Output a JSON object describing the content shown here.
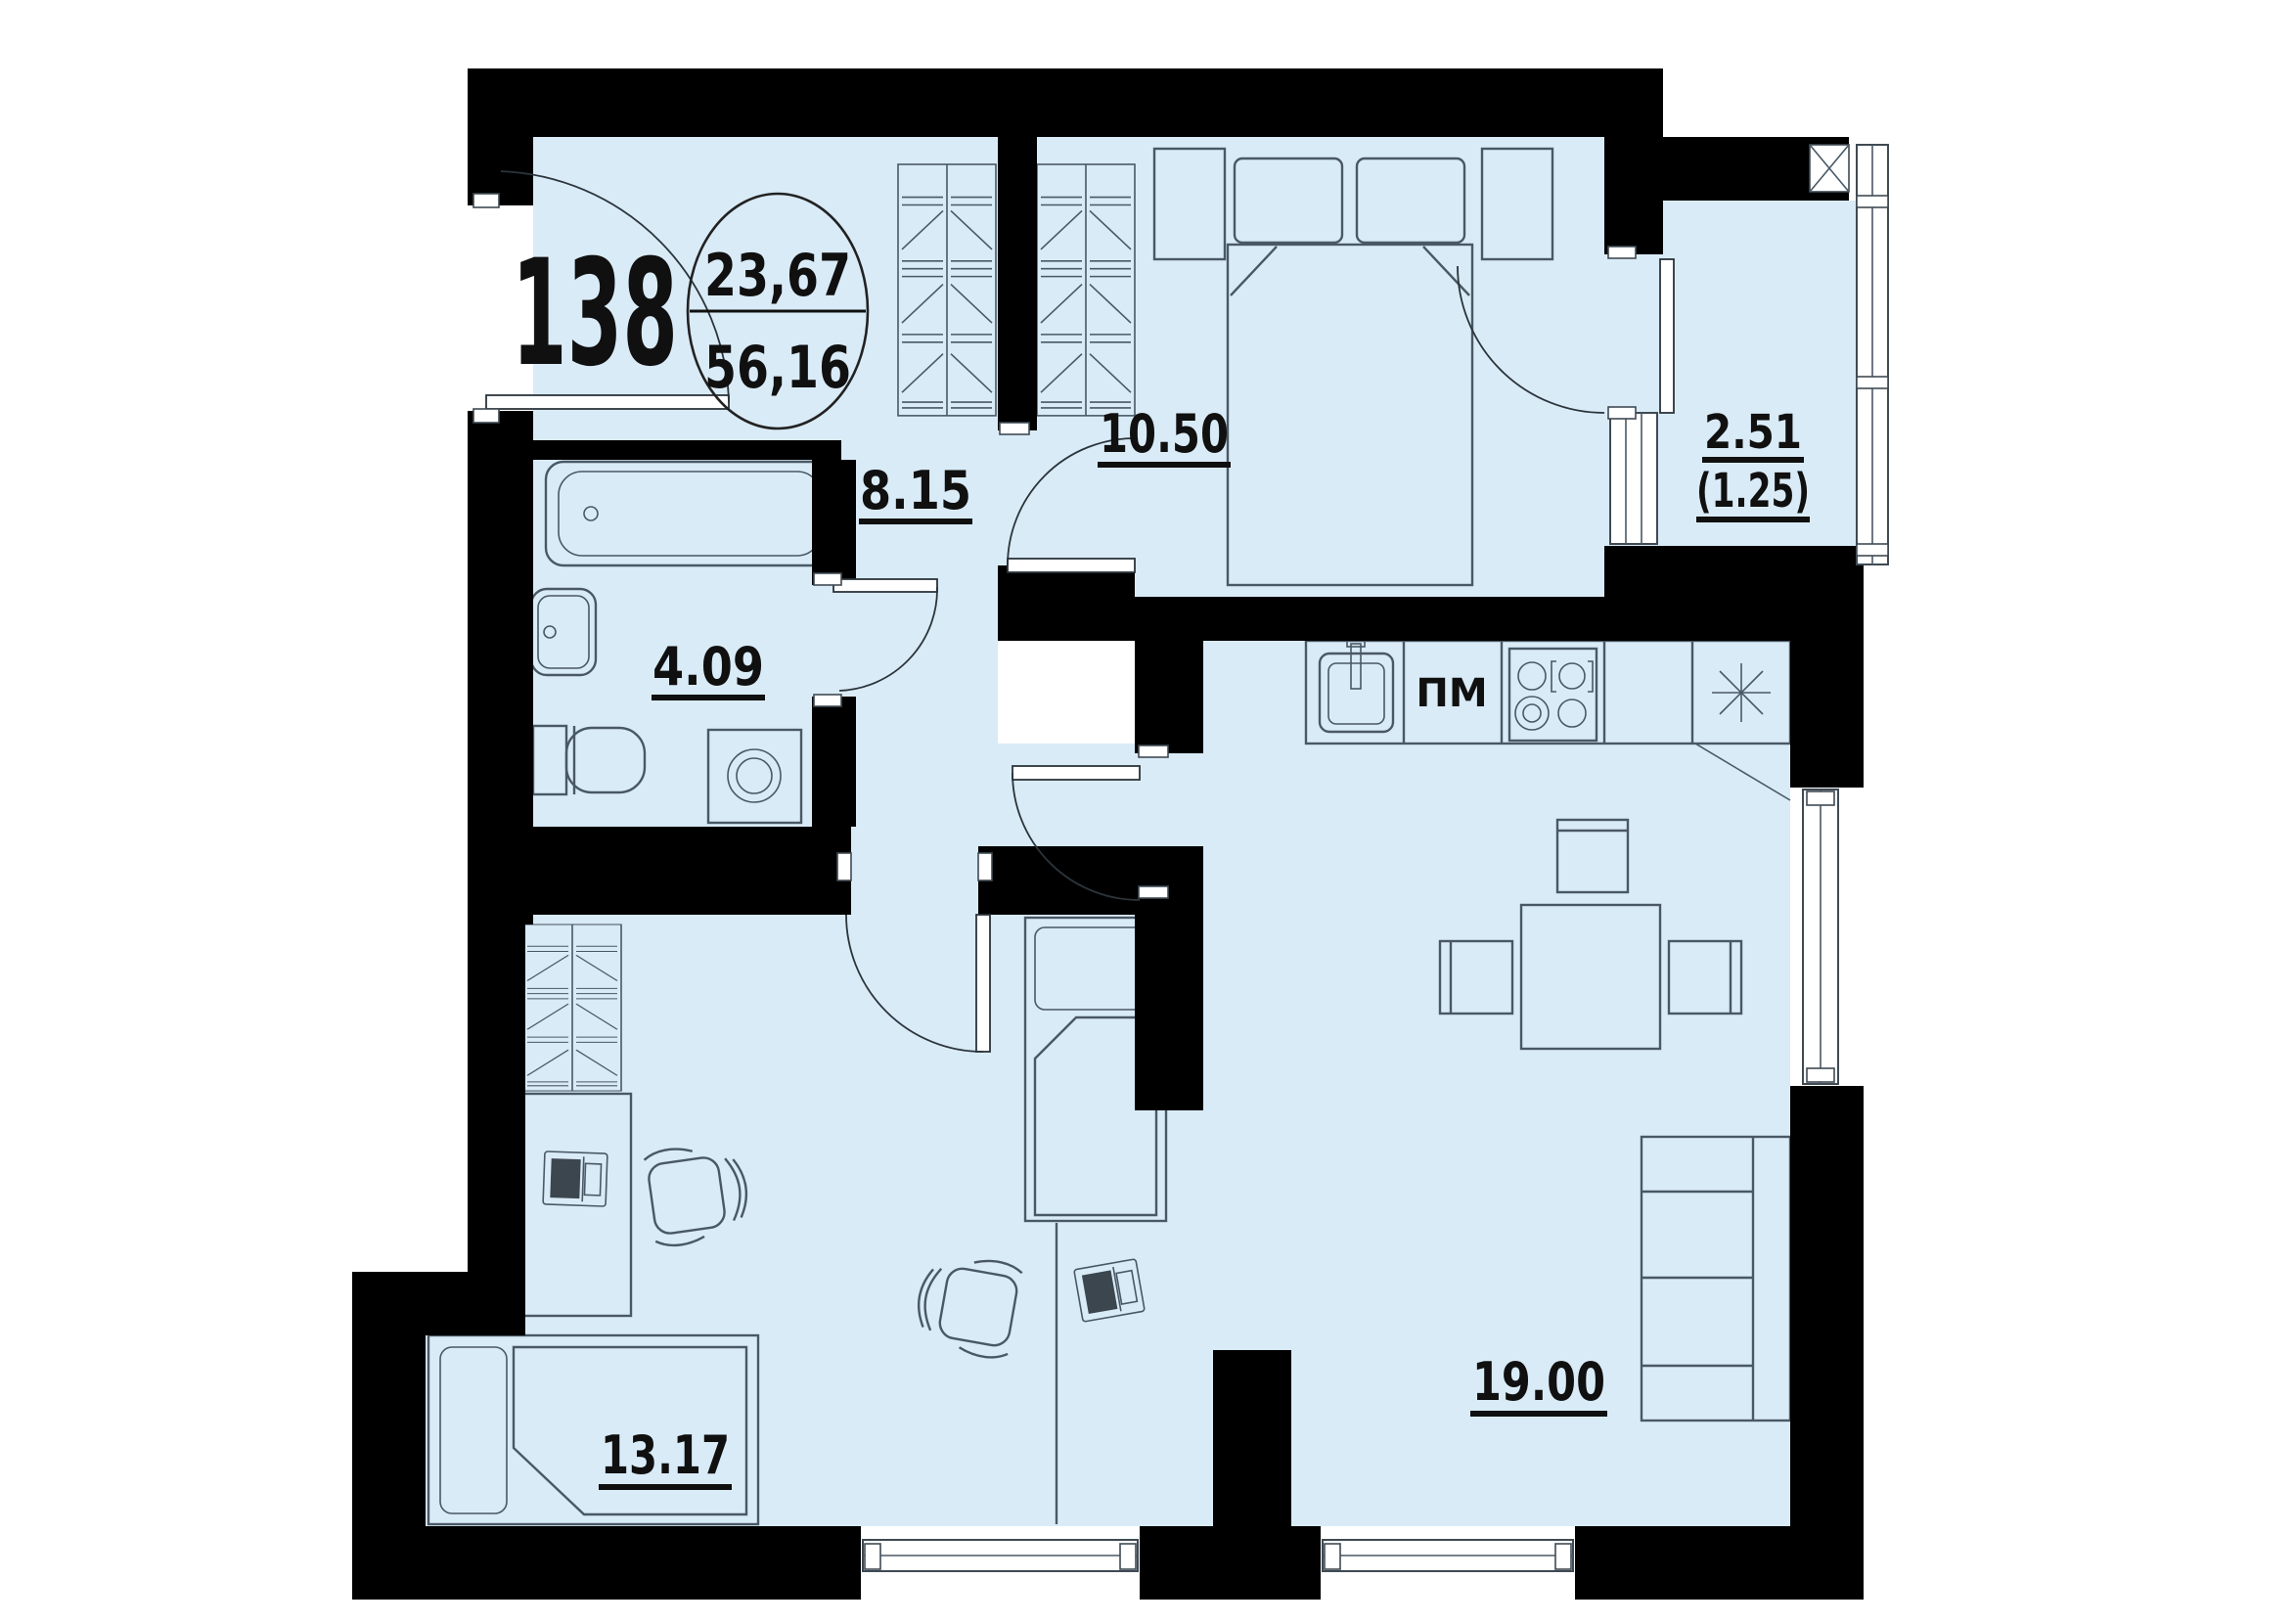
{
  "plan": {
    "apartment_number": "138",
    "area_circle": {
      "living_area": "23,67",
      "total_area": "56,16"
    },
    "rooms": [
      {
        "id": "hallway",
        "area_label": "8.15"
      },
      {
        "id": "bathroom",
        "area_label": "4.09"
      },
      {
        "id": "bedroom",
        "area_label": "10.50"
      },
      {
        "id": "children-room",
        "area_label": "13.17"
      },
      {
        "id": "kitchen-living-room",
        "area_label": "19.00"
      },
      {
        "id": "balcony",
        "area_label": "2.51",
        "area_label_reduced": "(1.25)"
      }
    ],
    "kitchen": {
      "dishwasher_label": "ПМ"
    },
    "colors": {
      "floor_fill": "#d9ebf7",
      "wall": "#000000",
      "furniture_line": "#4a5865"
    }
  }
}
